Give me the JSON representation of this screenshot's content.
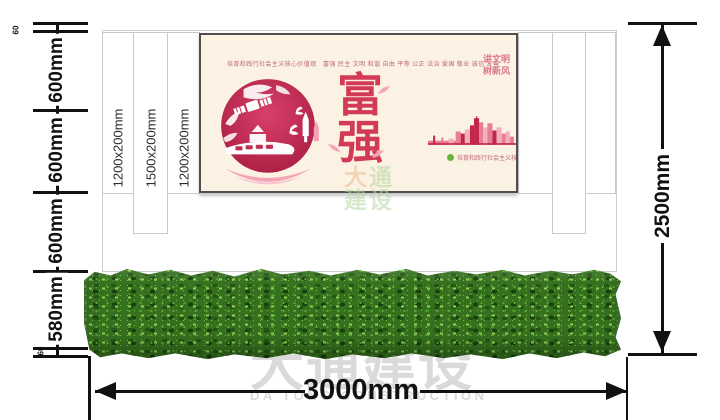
{
  "dims": {
    "left": [
      "60",
      "600mm",
      "600mm",
      "600mm",
      "580mm",
      "60"
    ],
    "right_total": "2500mm",
    "bottom_total": "3000mm"
  },
  "panels": {
    "labels": [
      "1200x200mm",
      "1500x200mm",
      "1200x200mm"
    ]
  },
  "poster": {
    "slogan_top": "培育和践行社会主义核心价值观　富强 民主 文明 和谐 自由 平等 公正 法治 爱国 敬业 诚信 友善",
    "main_chars": [
      "富",
      "强"
    ],
    "corner_lines": [
      "讲文明",
      "树新风"
    ],
    "footer_note": "培育和践行社会主义核心价值观 公益广告",
    "skyline": {
      "colors": {
        "a": "#c2274a",
        "b": "#e87d93",
        "c": "#f3afbd"
      },
      "bars": [
        {
          "x": 0,
          "w": 30,
          "h": 4,
          "c": "b"
        },
        {
          "x": 5,
          "w": 2,
          "h": 9,
          "c": "a"
        },
        {
          "x": 13,
          "w": 2,
          "h": 7,
          "c": "b"
        },
        {
          "x": 20,
          "w": 5,
          "h": 6,
          "c": "c"
        },
        {
          "x": 27,
          "w": 5,
          "h": 13,
          "c": "b"
        },
        {
          "x": 32,
          "w": 4,
          "h": 11,
          "c": "a"
        },
        {
          "x": 36,
          "w": 5,
          "h": 15,
          "c": "c"
        },
        {
          "x": 41,
          "w": 4,
          "h": 19,
          "c": "a"
        },
        {
          "x": 45,
          "w": 5,
          "h": 26,
          "c": "a"
        },
        {
          "x": 47,
          "w": 1.2,
          "h": 28,
          "c": "a"
        },
        {
          "x": 50,
          "w": 4,
          "h": 22,
          "c": "b"
        },
        {
          "x": 54,
          "w": 4,
          "h": 17,
          "c": "c"
        },
        {
          "x": 58,
          "w": 5,
          "h": 21,
          "c": "b"
        },
        {
          "x": 63,
          "w": 4,
          "h": 14,
          "c": "a"
        },
        {
          "x": 67,
          "w": 5,
          "h": 17,
          "c": "c"
        },
        {
          "x": 72,
          "w": 4,
          "h": 11,
          "c": "b"
        },
        {
          "x": 76,
          "w": 4,
          "h": 13,
          "c": "c"
        },
        {
          "x": 80,
          "w": 4,
          "h": 8,
          "c": "b"
        },
        {
          "x": 0,
          "w": 86,
          "h": 1.6,
          "c": "a"
        }
      ]
    }
  },
  "watermark_center": {
    "chars": [
      "大",
      "通",
      "建",
      "设"
    ]
  },
  "watermark_bottom": {
    "cn": "大通建设",
    "en": "DA TONG CONSTRUCTION"
  },
  "colors": {
    "accent_red": "#c92a4d",
    "poster_bg": "#fcf2e3",
    "hedge_green": "#35701f",
    "dim_line": "#111111",
    "watermark_gray": "#d2d2d2"
  }
}
